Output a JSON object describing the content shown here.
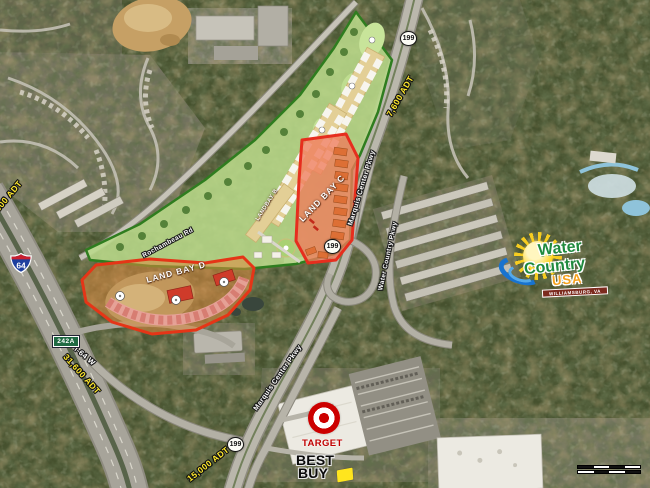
{
  "shields": {
    "route_199": "199",
    "interstate_64": "64",
    "exit_242a": "242A"
  },
  "roads": {
    "rochambeau": "Rochambeau Rd",
    "marquis_center_north": "Marquis Center Pkwy",
    "water_country": "Water Country Pkwy",
    "marquis_center_south": "Marquis Center Pkwy",
    "i64_west": "I-64 W"
  },
  "traffic": {
    "route199_north_adt": "7,600 ADT",
    "i64_adt": "31,600 ADT",
    "i64_adt_edge": "31,600 ADT",
    "route199_south_adt": "15,000 ADT"
  },
  "land_bays": {
    "bay_b": "LANDBAY B",
    "bay_c": "LAND BAY C",
    "bay_d": "LAND BAY D"
  },
  "logos": {
    "water_country": {
      "word1": "Water",
      "word2": "Country",
      "word3": "USA",
      "banner": "WILLIAMSBURG, VA"
    },
    "target": {
      "label": "TARGET"
    },
    "best_buy": {
      "line1": "BEST",
      "line2": "BUY"
    }
  }
}
